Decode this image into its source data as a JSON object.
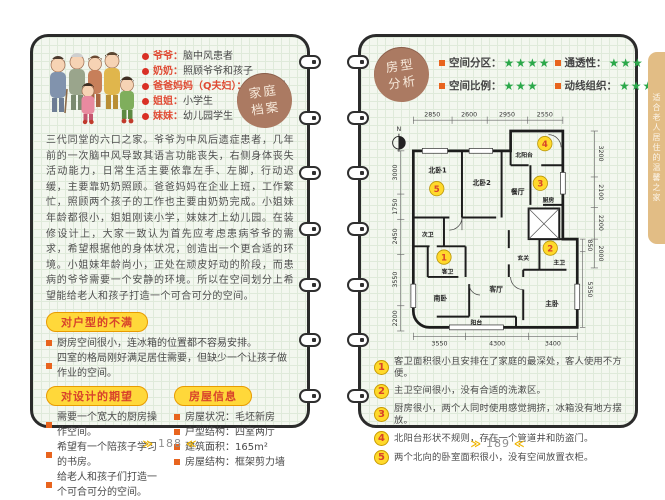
{
  "left": {
    "badge": {
      "line1": "家庭",
      "line2": "档案"
    },
    "family": [
      {
        "role": "爷爷：",
        "desc": "脑中风患者"
      },
      {
        "role": "奶奶：",
        "desc": "照顾爷爷和孩子"
      },
      {
        "role": "爸爸妈妈（Q夫妇）：",
        "desc": "企业职员"
      },
      {
        "role": "姐姐：",
        "desc": "小学生"
      },
      {
        "role": "妹妹：",
        "desc": "幼儿园学生"
      }
    ],
    "intro": "三代同堂的六口之家。爷爷为中风后遗症患者，几年前的一次脑中风导致其语言功能丧失，右侧身体丧失活动能力，日常生活主要依靠左手、左脚，行动迟缓，主要靠奶奶照顾。爸爸妈妈在企业上班，工作繁忙，照顾两个孩子的工作也主要由奶奶完成。小姐妹年龄都很小，姐姐刚读小学，妹妹才上幼儿园。在装修设计上，大家一致认为首先应考虑患病爷爷的需求，希望根据他的身体状况，创造出一个更合适的环境。小姐妹年龄尚小，正处在顽皮好动的阶段，而患病的爷爷需要一个安静的环境。所以在空间划分上希望能给老人和孩子打造一个可合可分的空间。",
    "complaints_title": "对户型的不满",
    "complaints": [
      "厨房空间很小，连冰箱的位置都不容易安排。",
      "四室的格局刚好满足居住需要，但缺少一个让孩子做作业的空间。"
    ],
    "expectations_title": "对设计的期望",
    "expectations": [
      "需要一个宽大的厨房操作空间。",
      "希望有一个陪孩子学习的书房。",
      "给老人和孩子们打造一个可合可分的空间。"
    ],
    "house_info_title": "房屋信息",
    "house_info": [
      {
        "label": "房屋状况：",
        "value": "毛坯新房"
      },
      {
        "label": "户型结构：",
        "value": "四室两厅"
      },
      {
        "label": "建筑面积：",
        "value": "165m²"
      },
      {
        "label": "房屋结构：",
        "value": "框架剪力墙"
      }
    ],
    "page_number": "188"
  },
  "right": {
    "badge": {
      "line1": "房型",
      "line2": "分析"
    },
    "ratings": [
      {
        "label": "空间分区：",
        "stars": "★★★★"
      },
      {
        "label": "空间比例：",
        "stars": "★★★"
      },
      {
        "label": "通透性：",
        "stars": "★★★"
      },
      {
        "label": "动线组织：",
        "stars": "★★★★"
      }
    ],
    "plan": {
      "north": "N",
      "dims_top": [
        "2850",
        "2600",
        "2950",
        "2550"
      ],
      "dims_left": [
        "3000",
        "1750",
        "2450",
        "3550",
        "2200"
      ],
      "dims_right": [
        "3200",
        "2100",
        "2200",
        "2000"
      ],
      "dims_right_inner": [
        "850",
        "5350"
      ],
      "dims_bottom": [
        "3550",
        "4300",
        "3400"
      ],
      "rooms": {
        "north_bed1": "北卧1",
        "north_bed2": "北卧2",
        "dining": "餐厅",
        "north_balcony": "北阳台",
        "kitchen": "厨房",
        "second_bath": "次卫",
        "guest_bath": "客卫",
        "foyer": "玄关",
        "south_bed": "南卧",
        "living": "客厅",
        "balcony": "阳台",
        "master_bed": "主卧",
        "master_bath": "主卫"
      },
      "badges": [
        "1",
        "2",
        "3",
        "4",
        "5"
      ]
    },
    "analysis": [
      {
        "num": "1",
        "text": "客卫面积很小且安排在了家庭的最深处，客人使用不方便。"
      },
      {
        "num": "2",
        "text": "主卫空间很小，没有合适的洗漱区。"
      },
      {
        "num": "3",
        "text": "厨房很小，两个人同时使用感觉拥挤，冰箱没有地方摆放。"
      },
      {
        "num": "4",
        "text": "北阳台形状不规则，存在一个管道井和防盗门。"
      },
      {
        "num": "5",
        "text": "两个北向的卧室面积很小，没有空间放置衣柜。"
      }
    ],
    "page_number": "189"
  },
  "side_tab": {
    "text": "适合老人居住的温馨之家"
  },
  "icons": {
    "footer_arrow_left": "≫",
    "footer_arrow_right": "≪"
  },
  "colors": {
    "accent_red": "#d8432b",
    "pill_yellow": "#ffd83a",
    "star_green": "#2ba84a",
    "badge_brown": "#ab7a62",
    "tab_tan": "#e2bd85",
    "number_yellow": "#ffd92b"
  }
}
